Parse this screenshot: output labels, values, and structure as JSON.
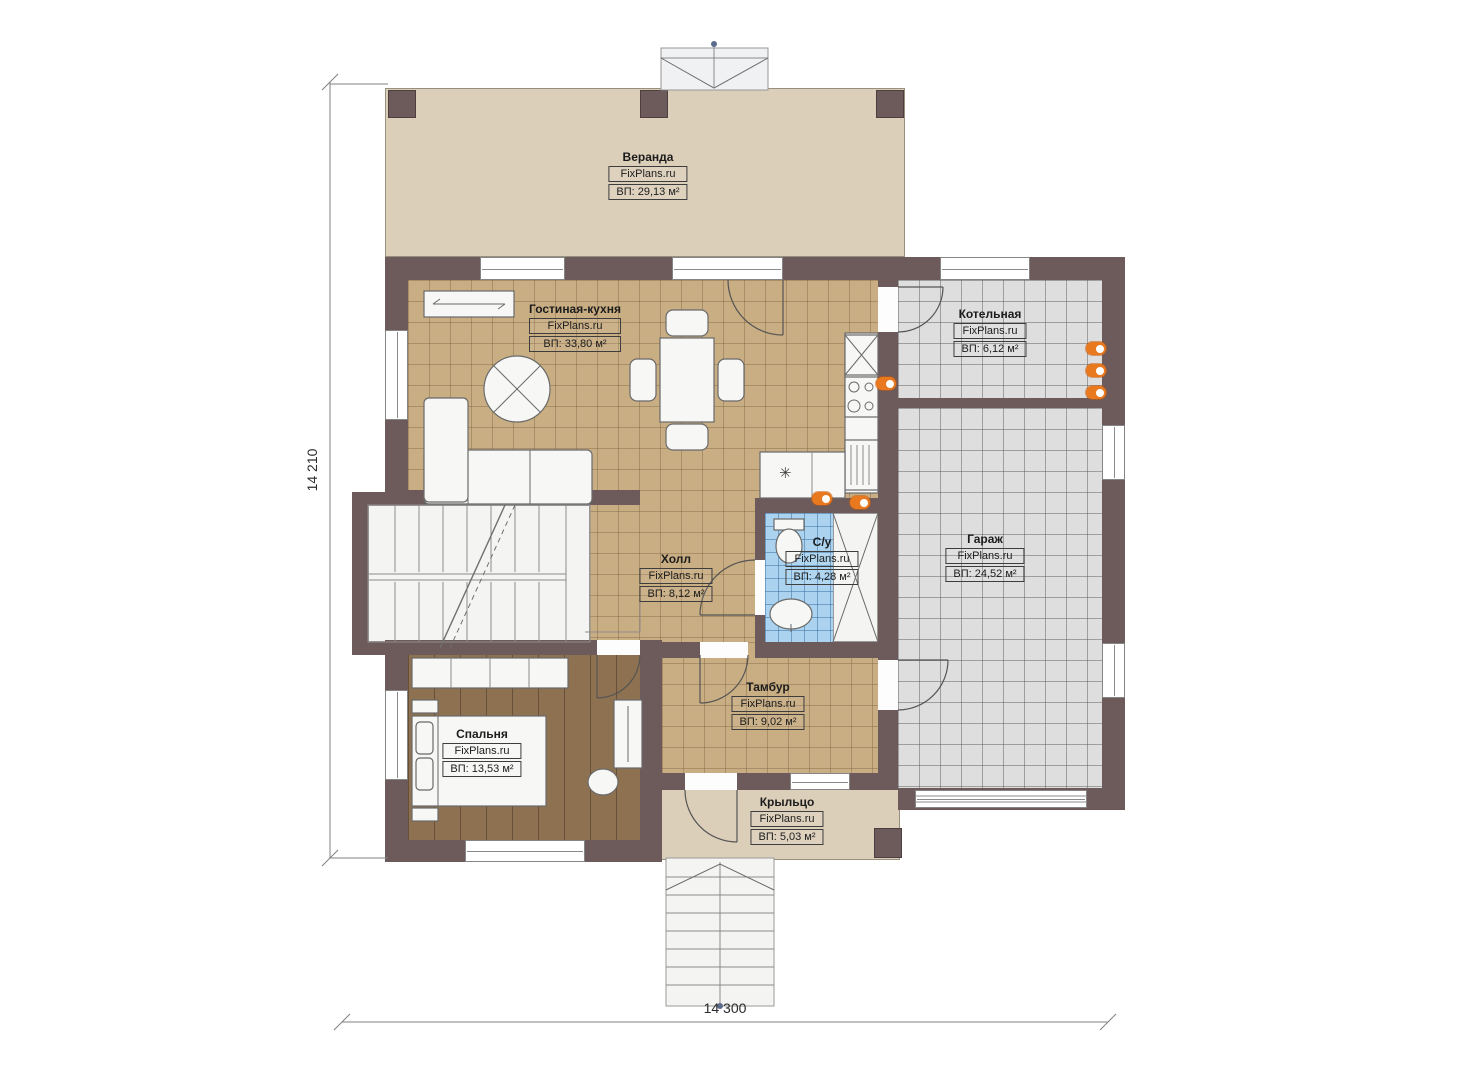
{
  "watermark": "FixPlans.ru",
  "dimension_labels": {
    "left": "14 210",
    "bottom": "14 300"
  },
  "rooms": {
    "veranda": {
      "name": "Веранда",
      "area": "ВП: 29,13 м²"
    },
    "living_kitchen": {
      "name": "Гостиная-кухня",
      "area": "ВП: 33,80 м²"
    },
    "boiler": {
      "name": "Котельная",
      "area": "ВП: 6,12 м²"
    },
    "garage": {
      "name": "Гараж",
      "area": "ВП: 24,52 м²"
    },
    "hall": {
      "name": "Холл",
      "area": "ВП: 8,12 м²"
    },
    "bathroom": {
      "name": "С/у",
      "area": "ВП: 4,28 м²"
    },
    "vestibule": {
      "name": "Тамбур",
      "area": "ВП: 9,02 м²"
    },
    "bedroom": {
      "name": "Спальня",
      "area": "ВП: 13,53 м²"
    },
    "porch": {
      "name": "Крыльцо",
      "area": "ВП: 5,03 м²"
    }
  },
  "icons": {
    "fridge_snowflake": "✳"
  },
  "colors": {
    "wall": "#6d5b5b",
    "tile_tan": "#c9ad83",
    "tile_gray": "#dedede",
    "tile_blue": "#abd3ef",
    "wood": "#8d7150",
    "slab_beige": "#dccfba",
    "accent_orange": "#e8791f"
  }
}
